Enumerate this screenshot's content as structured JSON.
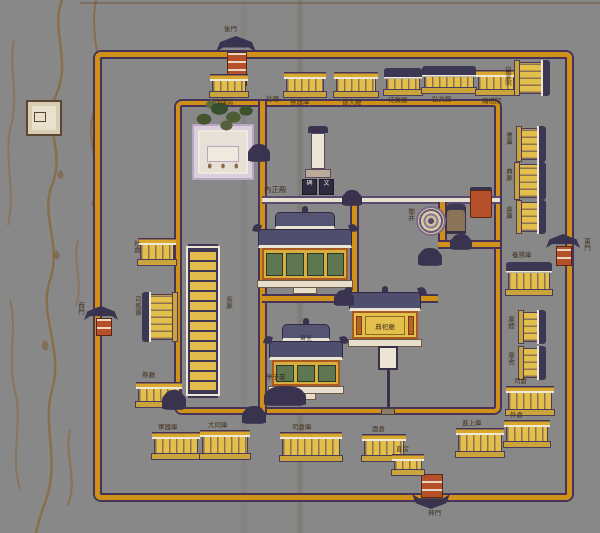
{
  "palette": {
    "paper": "#d3c496",
    "wall_orange": "#cf9118",
    "wall_edge": "#473358",
    "roof_dark": "#3c3752",
    "building_yellow": "#e3bf4c",
    "panel_green": "#5e7750",
    "pillar_orange": "#b86226",
    "white_trim": "#ece5d3",
    "ink": "#43321f",
    "terrain_brown": "#8a6a42"
  },
  "gates": {
    "north": {
      "label": "後門"
    },
    "east": {
      "label": "東門"
    },
    "west": {
      "label": "西門"
    },
    "south": {
      "label": "神門"
    }
  },
  "features": {
    "main_hall": {
      "label": "內正殿"
    },
    "hall_b": {
      "label": "齋室"
    },
    "hall_c": {
      "label": "典祀廳"
    },
    "corridor": {
      "label": "長廊"
    },
    "altar": {
      "label": "社壇"
    },
    "small_pavilion": {
      "label": "亭子臺"
    },
    "well": {
      "label": "御井"
    },
    "stele": {
      "plaque_left": "碑",
      "plaque_right": "文"
    }
  },
  "storehouses": [
    {
      "x": 212,
      "y": 74,
      "w": 34,
      "h": 24,
      "label": "守僕房",
      "lx": 214,
      "ly": 99
    },
    {
      "x": 286,
      "y": 72,
      "w": 38,
      "h": 26,
      "label": "祭器庫",
      "lx": 290,
      "ly": 99
    },
    {
      "x": 336,
      "y": 72,
      "w": 40,
      "h": 26,
      "label": "香大廳",
      "lx": 342,
      "ly": 99
    },
    {
      "x": 386,
      "y": 68,
      "w": 34,
      "h": 28,
      "roof": "dark",
      "label": "待賓廳",
      "lx": 388,
      "ly": 97
    },
    {
      "x": 424,
      "y": 66,
      "w": 50,
      "h": 28,
      "roof": "dark",
      "label": "弘文館",
      "lx": 432,
      "ly": 96
    },
    {
      "x": 478,
      "y": 70,
      "w": 36,
      "h": 26,
      "label": "兩塔院",
      "lx": 482,
      "ly": 98
    },
    {
      "x": 514,
      "y": 62,
      "w": 36,
      "h": 32,
      "o": "vr",
      "roof": "dark",
      "label": "白雲院",
      "lx": 503,
      "ly": 66,
      "lv": 1
    },
    {
      "x": 516,
      "y": 128,
      "w": 30,
      "h": 32,
      "o": "vr",
      "label": "書庫",
      "lx": 504,
      "ly": 132,
      "lv": 1
    },
    {
      "x": 514,
      "y": 164,
      "w": 32,
      "h": 34,
      "o": "vr",
      "roof": "dark",
      "label": "典廊",
      "lx": 504,
      "ly": 168,
      "lv": 1
    },
    {
      "x": 516,
      "y": 202,
      "w": 30,
      "h": 30,
      "o": "vr",
      "label": "倉庫",
      "lx": 504,
      "ly": 206,
      "lv": 1
    },
    {
      "x": 508,
      "y": 262,
      "w": 42,
      "h": 34,
      "roof": "dark",
      "label": "養賢庫",
      "lx": 512,
      "ly": 252
    },
    {
      "x": 518,
      "y": 312,
      "w": 28,
      "h": 30,
      "o": "vr",
      "label": "庫間",
      "lx": 506,
      "ly": 316,
      "lv": 1
    },
    {
      "x": 518,
      "y": 348,
      "w": 28,
      "h": 30,
      "o": "vr",
      "label": "庫舍",
      "lx": 506,
      "ly": 352,
      "lv": 1
    },
    {
      "x": 508,
      "y": 386,
      "w": 44,
      "h": 30,
      "label": "司倉",
      "lx": 514,
      "ly": 378
    },
    {
      "x": 154,
      "y": 432,
      "w": 44,
      "h": 28,
      "label": "軍器庫",
      "lx": 158,
      "ly": 424
    },
    {
      "x": 202,
      "y": 430,
      "w": 46,
      "h": 30,
      "label": "大同庫",
      "lx": 208,
      "ly": 422
    },
    {
      "x": 282,
      "y": 432,
      "w": 58,
      "h": 30,
      "label": "司倉庫",
      "lx": 292,
      "ly": 424
    },
    {
      "x": 364,
      "y": 434,
      "w": 40,
      "h": 28,
      "label": "面倉",
      "lx": 372,
      "ly": 426
    },
    {
      "x": 394,
      "y": 454,
      "w": 28,
      "h": 22,
      "label": "直房",
      "lx": 396,
      "ly": 446
    },
    {
      "x": 458,
      "y": 428,
      "w": 44,
      "h": 30,
      "label": "進上庫",
      "lx": 462,
      "ly": 420
    },
    {
      "x": 506,
      "y": 420,
      "w": 42,
      "h": 28,
      "label": "外倉",
      "lx": 510,
      "ly": 412
    },
    {
      "x": 140,
      "y": 238,
      "w": 34,
      "h": 28,
      "label": "社倉",
      "lx": 132,
      "ly": 240,
      "lv": 1
    },
    {
      "x": 142,
      "y": 294,
      "w": 36,
      "h": 46,
      "o": "vl",
      "roof": "dark",
      "label": "司馬齋",
      "lx": 133,
      "ly": 296,
      "lv": 1
    },
    {
      "x": 138,
      "y": 382,
      "w": 42,
      "h": 26,
      "label": "祭廳",
      "lx": 142,
      "ly": 372
    }
  ],
  "inner_gates": [
    {
      "x": 250,
      "y": 144,
      "w": 18,
      "h": 16
    },
    {
      "x": 344,
      "y": 190,
      "w": 16,
      "h": 14
    },
    {
      "x": 452,
      "y": 234,
      "w": 18,
      "h": 14
    },
    {
      "x": 336,
      "y": 290,
      "w": 16,
      "h": 14
    },
    {
      "x": 164,
      "y": 390,
      "w": 20,
      "h": 18
    },
    {
      "x": 244,
      "y": 406,
      "w": 20,
      "h": 16
    },
    {
      "x": 420,
      "y": 248,
      "w": 20,
      "h": 16
    }
  ]
}
